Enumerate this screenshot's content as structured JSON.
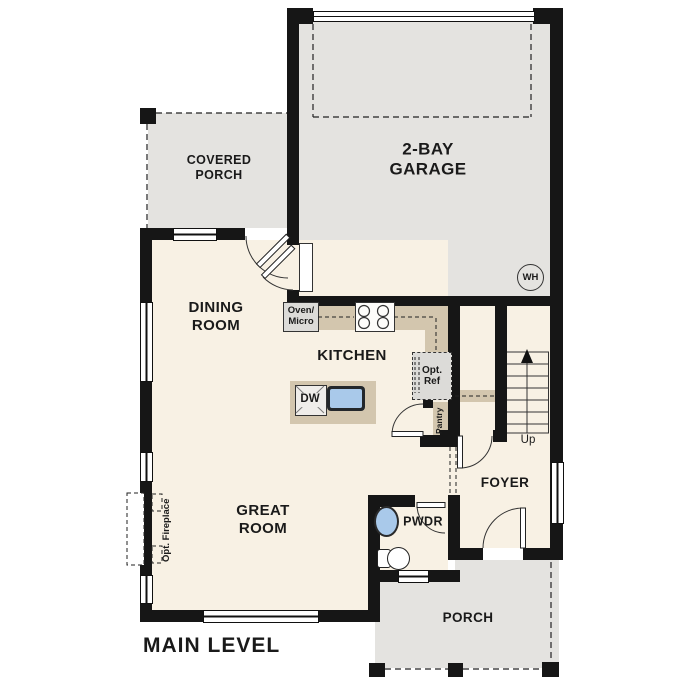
{
  "plan": {
    "title": "MAIN LEVEL"
  },
  "rooms": {
    "covered_porch": {
      "line1": "COVERED",
      "line2": "PORCH"
    },
    "garage": {
      "line1": "2-BAY",
      "line2": "GARAGE"
    },
    "dining": {
      "line1": "DINING",
      "line2": "ROOM"
    },
    "kitchen": {
      "line1": "KITCHEN"
    },
    "great_room": {
      "line1": "GREAT",
      "line2": "ROOM"
    },
    "foyer": {
      "line1": "FOYER"
    },
    "powder": {
      "line1": "PWDR"
    },
    "porch": {
      "line1": "PORCH"
    }
  },
  "fixtures": {
    "oven_micro": {
      "line1": "Oven/",
      "line2": "Micro"
    },
    "opt_ref": {
      "line1": "Opt.",
      "line2": "Ref"
    },
    "pantry": {
      "label": "Pantry"
    },
    "dishwasher": {
      "label": "DW"
    },
    "water_heater": {
      "label": "WH"
    },
    "stairs": {
      "label": "Up"
    },
    "fireplace": {
      "label": "Opt. Fireplace"
    }
  },
  "colors": {
    "wall": "#161616",
    "interior_floor": "#f8f1e4",
    "outdoor_floor": "#e4e3e0",
    "counter": "#d3c6ae",
    "appliance": "#dcdbd8",
    "sink": "#a9c9ea"
  }
}
